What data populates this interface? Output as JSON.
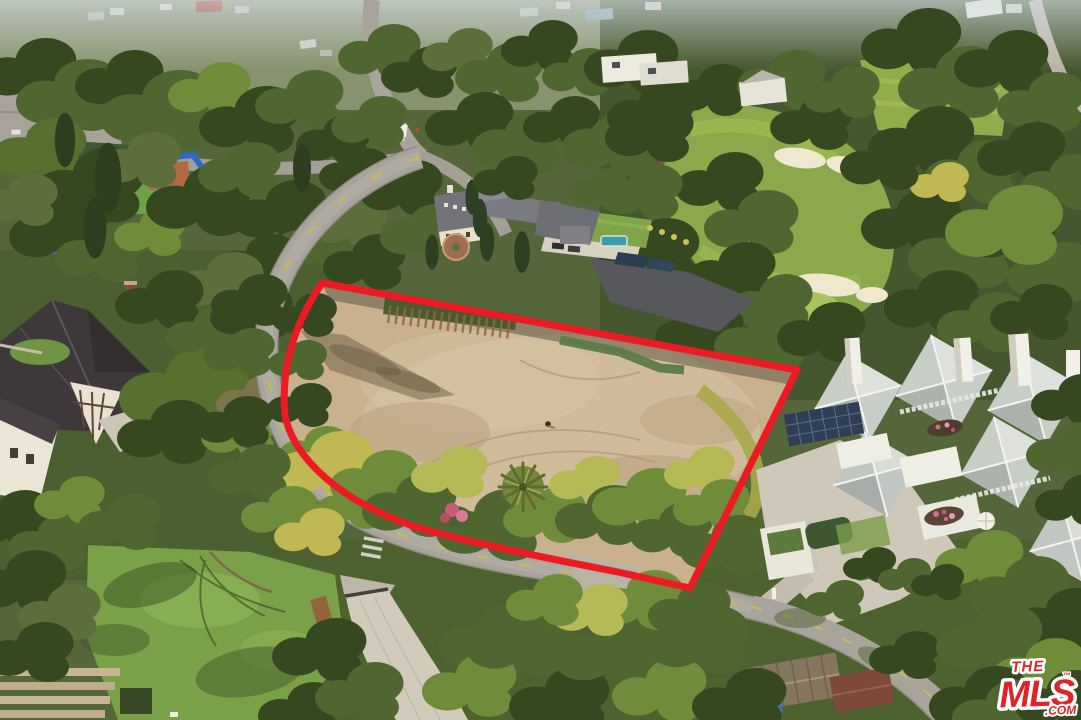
{
  "image": {
    "type": "aerial-drone-photograph",
    "description": "Daytime aerial real-estate photo of a flat vacant dirt lot outlined with a red boundary overlay. The lot is ringed by hedges and mature trees and a curving residential street with a yellow center line and crosswalks. Surroundings: a Tudor-style house lower left, a French chateau-style mansion with pool and solar annex top center, a golf-course fairway with sand bunkers and three golfers upper right, a white geometric compound of pyramidal roofs with tall chimneys and solar panels on the right, a parking lot and blue-fenced ballfield far left, hazy hillside homes along the top, and an MLS.com watermark bottom right."
  },
  "watermark": {
    "line1": "THE",
    "line2": "MLS",
    "trademark": "™",
    "suffix": ".COM",
    "letter_color": "#E32227",
    "casing_color": "#FFFFFF"
  },
  "colors": {
    "outline_red": "#EC1B23",
    "dirt_lot": "#C9B18E",
    "fairway_green": "#8BA94A",
    "tree_dark": "#3D5226",
    "road_gray": "#A8A49C",
    "yellow_line": "#D4BE44",
    "mansion_roof_slate": "#74757A",
    "pool_teal": "#3E9DAC",
    "modern_roof_gray": "#C9CDC8",
    "tudor_roof": "#3E383A",
    "ballfield_fence_blue": "#2B6BC4"
  },
  "scene": {
    "features": [
      {
        "name": "vacant-lot",
        "note": "graded tan dirt pad with tire-track arcs, tree shadows, small figure near center"
      },
      {
        "name": "property-outline",
        "note": "thick red boundary: straight top edge, angled right edge, curved road-following left/bottom edge"
      },
      {
        "name": "perimeter-road",
        "note": "curving street, yellow center line, two crosswalks"
      },
      {
        "name": "stick-fence",
        "note": "wooden stake fence along top edge of lot"
      },
      {
        "name": "palm-tree",
        "note": "single round palm inside lot near bottom"
      },
      {
        "name": "flower-bush",
        "note": "pink bougainvillea at lot frontage"
      },
      {
        "name": "golf-course",
        "note": "fairway, two bunker groups, putting green, three golfers"
      },
      {
        "name": "french-mansion",
        "note": "slate mansard roofs, cypresses, circular motor court, teal pool, solar annex"
      },
      {
        "name": "modern-compound",
        "note": "white pyramid-roof pavilions, tall white chimneys, rooftop solar array, umbrella, flower beds"
      },
      {
        "name": "tudor-house",
        "note": "steep dark roofs, half-timbered gable, driveway with white SUV"
      },
      {
        "name": "parking-lot",
        "note": "two rows of parked cars, upper left"
      },
      {
        "name": "ballfield",
        "note": "blue outfield fence, infield dirt, green backstop building"
      },
      {
        "name": "lawn",
        "note": "bottom-left lawn with bare-tree and canopy shadows, wooden terrace steps"
      },
      {
        "name": "driveway",
        "note": "concrete drive with gate curving to bottom edge"
      },
      {
        "name": "sheds",
        "note": "brown metal-roof sheds and blue tarp among bottom trees"
      },
      {
        "name": "hillside-homes",
        "note": "hazy rooftops along top edge"
      },
      {
        "name": "mls-watermark",
        "note": "red THE MLS .COM logo with white casing, bottom right"
      }
    ]
  }
}
